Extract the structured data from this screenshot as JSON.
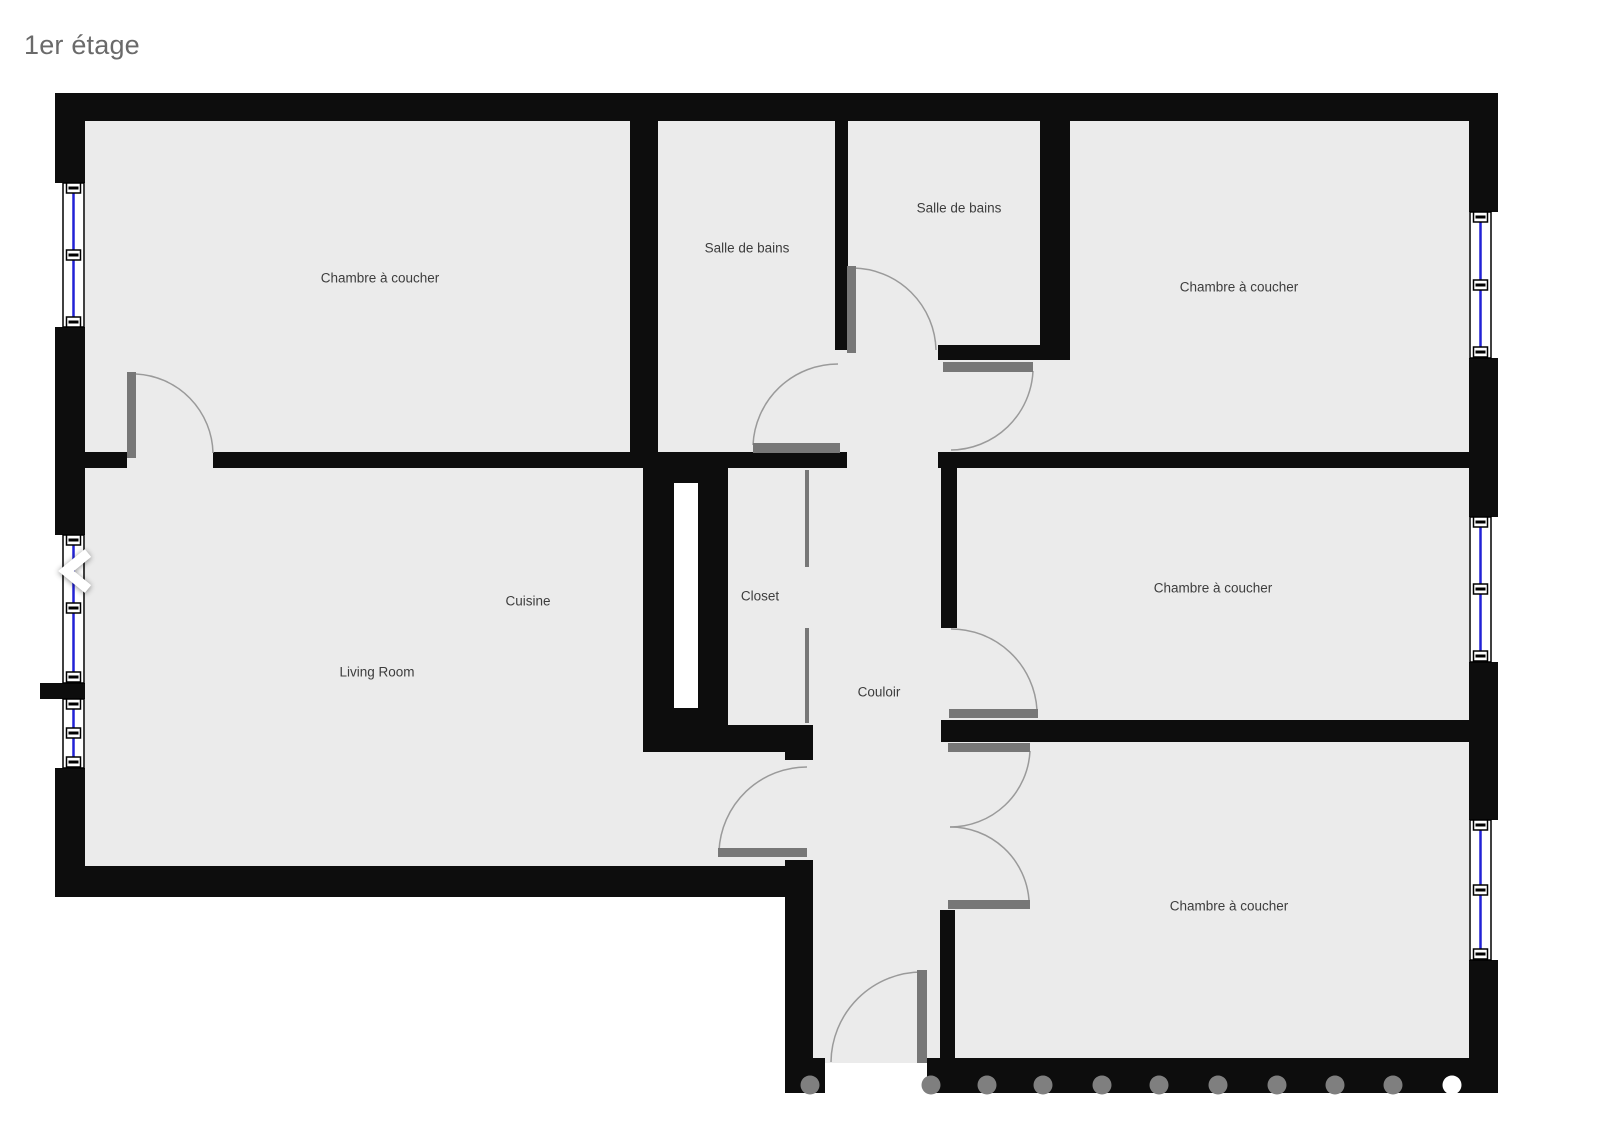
{
  "title": "1er étage",
  "rooms": {
    "bedroom_top_left": {
      "label": "Chambre à coucher"
    },
    "bathroom_left": {
      "label": "Salle de bains"
    },
    "bathroom_right": {
      "label": "Salle de bains"
    },
    "bedroom_top_right": {
      "label": "Chambre à coucher"
    },
    "cuisine": {
      "label": "Cuisine"
    },
    "closet": {
      "label": "Closet"
    },
    "living_room": {
      "label": "Living Room"
    },
    "couloir": {
      "label": "Couloir"
    },
    "bedroom_middle_right": {
      "label": "Chambre à coucher"
    },
    "bedroom_bottom_right": {
      "label": "Chambre à coucher"
    }
  },
  "colors": {
    "background": "#ffffff",
    "floor": "#ebebeb",
    "wall": "#0d0d0d",
    "window_glass": "#2222d6",
    "window_frame": "#000000",
    "door_leaf": "#777777",
    "arc": "#9a9a9a",
    "post_gray": "#7f7f7f",
    "post_highlight": "#ffffff",
    "label_text": "#3d3d3d",
    "title_text": "#6a6a6a",
    "nav_arrow": "#ffffff"
  }
}
